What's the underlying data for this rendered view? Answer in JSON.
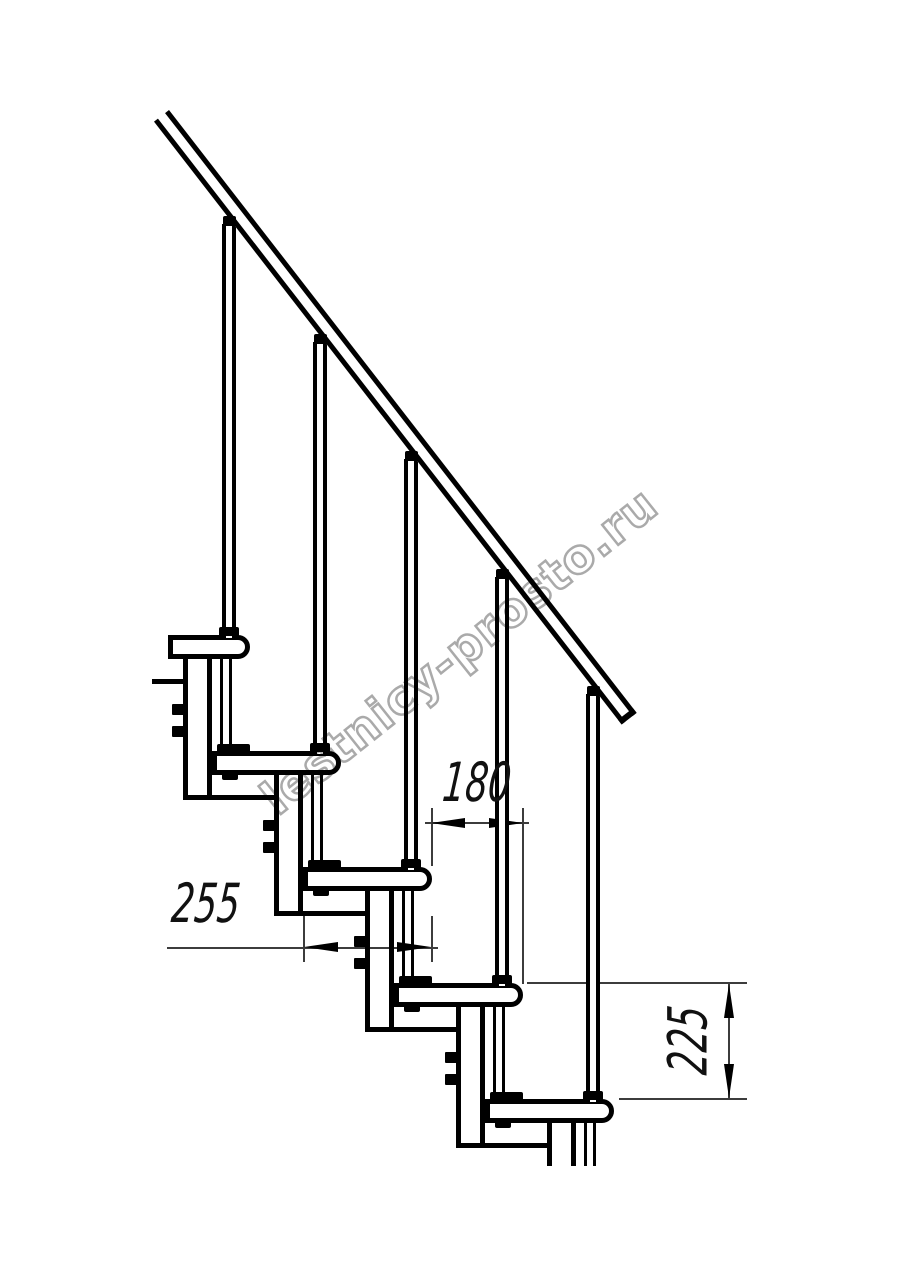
{
  "drawing": {
    "type": "staircase-side-view-technical-drawing",
    "watermark": "lestnicy-prosto.ru",
    "dimensions": {
      "step_run_mm": "180",
      "tread_depth_mm": "255",
      "step_rise_mm": "225"
    },
    "colors": {
      "line": "#000000",
      "dim_line": "#3c3c3c",
      "watermark_stroke": "#aaaaaa",
      "background": "#ffffff"
    }
  }
}
